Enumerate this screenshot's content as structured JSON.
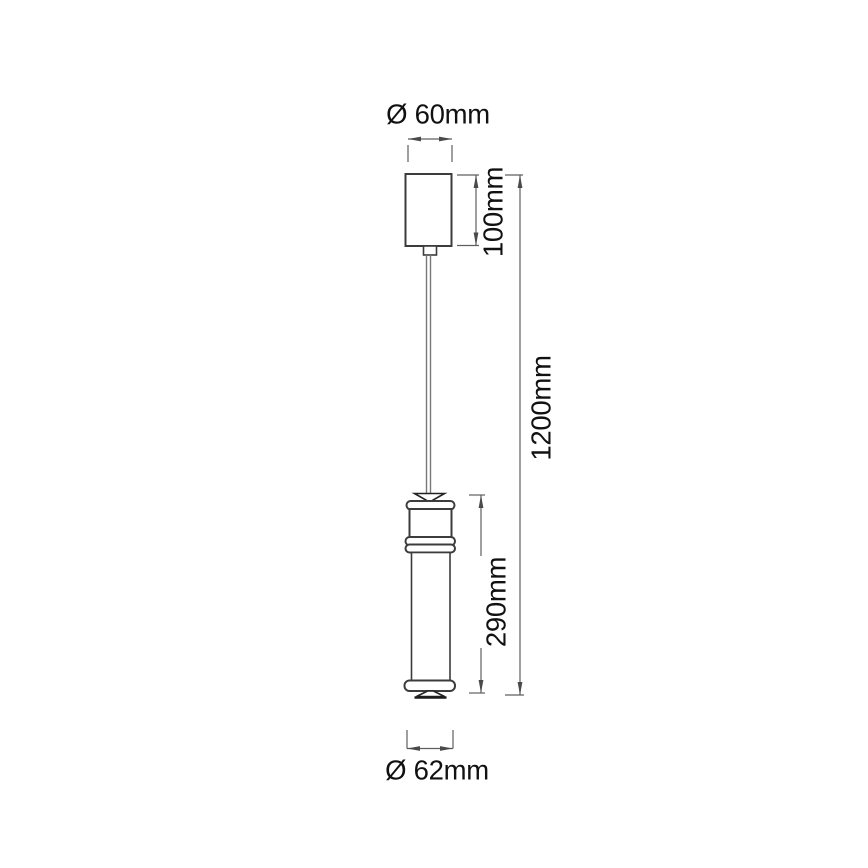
{
  "figure": {
    "type": "technical-dimension-drawing",
    "subject": "pendant lamp line drawing with dimensions",
    "dimensions": {
      "canopy_diameter": "Ø 60mm",
      "canopy_height": "100mm",
      "total_height": "1200mm",
      "lamp_body_height": "290mm",
      "lamp_diameter": "Ø 62mm"
    },
    "colors": {
      "background": "#ffffff",
      "outline": "#3c3c3c",
      "dimension_lines": "#5f5f5f",
      "text": "#111111"
    }
  }
}
